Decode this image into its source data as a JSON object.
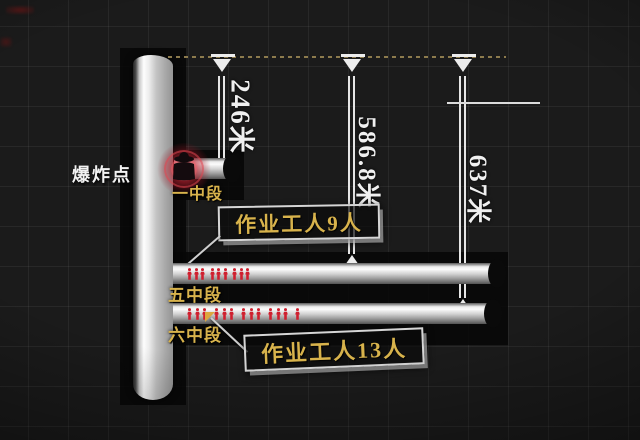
{
  "labels": {
    "explosion_point": "爆炸点",
    "level1": "一中段",
    "level5": "五中段",
    "level6": "六中段"
  },
  "measurements": [
    {
      "value": "246米"
    },
    {
      "value": "586.8米"
    },
    {
      "value": "637米"
    }
  ],
  "callouts": [
    {
      "text": "作业工人9人"
    },
    {
      "text": "作业工人13人"
    }
  ],
  "workers": [
    {
      "level": "五中段",
      "count": 9
    },
    {
      "level": "六中段",
      "count": 13
    }
  ],
  "colors": {
    "gold": "#d8b34c",
    "worker_red": "#cf1f2e",
    "measure_line": "#e8e8e8",
    "surface_dash": "#8d7b4d",
    "explosion_red": "#c3202f"
  }
}
